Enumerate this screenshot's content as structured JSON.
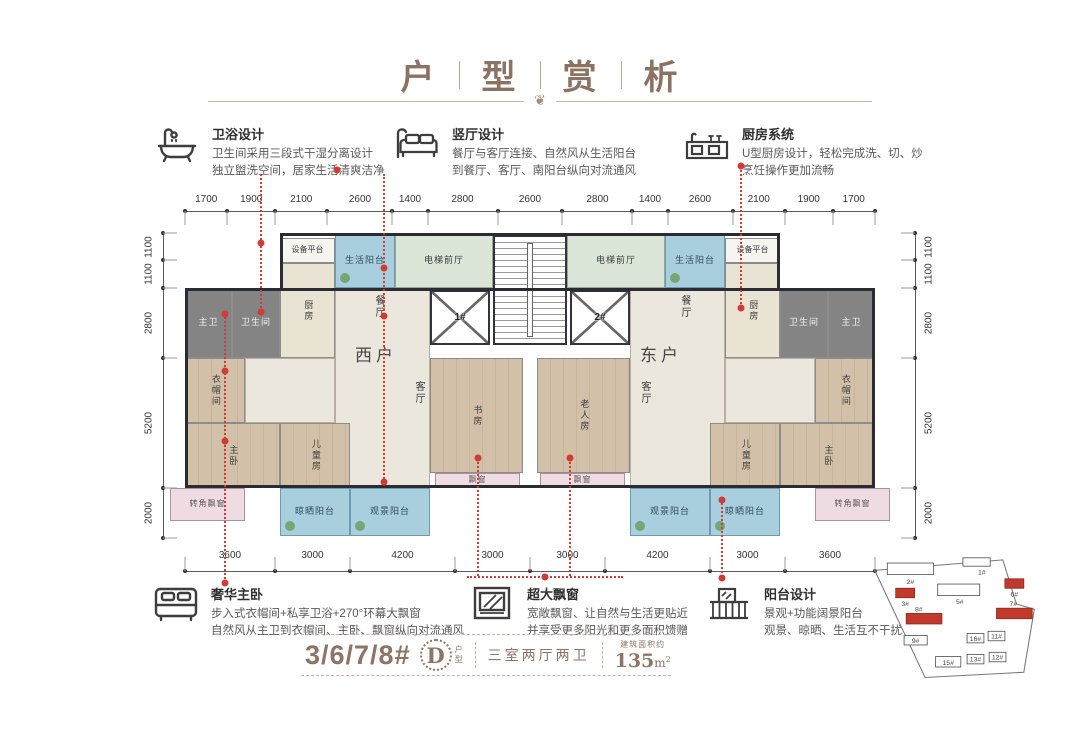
{
  "title": {
    "chars": [
      "户",
      "型",
      "赏",
      "析"
    ],
    "ornament": "❦"
  },
  "features_top": [
    {
      "icon": "bathtub-icon",
      "title": "卫浴设计",
      "lines": [
        "卫生间采用三段式干湿分离设计",
        "独立盥洗空间，居家生活清爽洁净"
      ]
    },
    {
      "icon": "sofa-lamp-icon",
      "title": "竖厅设计",
      "lines": [
        "餐厅与客厅连接、自然风从生活阳台",
        "到餐厅、客厅、南阳台纵向对流通风"
      ]
    },
    {
      "icon": "kitchen-icon",
      "title": "厨房系统",
      "lines": [
        "U型厨房设计，轻松完成洗、切、炒",
        "烹饪操作更加流畅"
      ]
    }
  ],
  "features_bottom": [
    {
      "icon": "bed-icon",
      "title": "奢华主卧",
      "lines": [
        "步入式衣帽间+私享卫浴+270°环幕大飘窗",
        "自然风从主卫到衣帽间、主卧、飘窗纵向对流通风"
      ]
    },
    {
      "icon": "window-icon",
      "title": "超大飘窗",
      "lines": [
        "宽敞飘窗、让自然与生活更贴近",
        "并享受更多阳光和更多面积馈赠"
      ]
    },
    {
      "icon": "balcony-icon",
      "title": "阳台设计",
      "lines": [
        "景观+功能阔景阳台",
        "观景、晾晒、生活互不干扰"
      ]
    }
  ],
  "dimensions": {
    "top": [
      1700,
      1900,
      2100,
      2600,
      1400,
      2800,
      2600,
      2800,
      1400,
      2600,
      2100,
      1900,
      1700
    ],
    "bottom": [
      3600,
      3000,
      4200,
      3000,
      3000,
      4200,
      3000,
      3600
    ],
    "side": [
      1100,
      1100,
      2800,
      5200,
      2000
    ]
  },
  "plan": {
    "rooms": [
      {
        "id": "living-dining-west",
        "label": "",
        "x": 150,
        "y": 55,
        "w": 95,
        "h": 200,
        "cls": "tile"
      },
      {
        "id": "corridor-west",
        "label": "",
        "x": 60,
        "y": 125,
        "w": 90,
        "h": 65,
        "cls": "tile"
      },
      {
        "id": "living-dining-east",
        "label": "",
        "x": 445,
        "y": 55,
        "w": 95,
        "h": 200,
        "cls": "tile"
      },
      {
        "id": "corridor-east",
        "label": "",
        "x": 540,
        "y": 125,
        "w": 90,
        "h": 65,
        "cls": "tile"
      },
      {
        "id": "equipment-platform-west",
        "label": "设备平台",
        "x": 95,
        "y": 5,
        "w": 55,
        "h": 25,
        "cls": "equip"
      },
      {
        "id": "life-balcony-west",
        "label": "生活阳台",
        "x": 150,
        "y": 0,
        "w": 60,
        "h": 55,
        "cls": "balcony"
      },
      {
        "id": "elevator-lobby-west",
        "label": "电梯前厅",
        "x": 210,
        "y": 0,
        "w": 98,
        "h": 55,
        "cls": "lobby"
      },
      {
        "id": "master-bath-west",
        "label": "主卫",
        "x": 0,
        "y": 55,
        "w": 47,
        "h": 70,
        "cls": "bath"
      },
      {
        "id": "bathroom-west",
        "label": "卫生间",
        "x": 47,
        "y": 55,
        "w": 48,
        "h": 70,
        "cls": "bath"
      },
      {
        "id": "kitchen-west",
        "label": "厨房",
        "x": 95,
        "y": 30,
        "w": 55,
        "h": 95,
        "cls": "kitchen",
        "vert": true
      },
      {
        "id": "closet-west",
        "label": "衣帽间",
        "x": 0,
        "y": 125,
        "w": 60,
        "h": 65,
        "cls": "wood",
        "vert": true
      },
      {
        "id": "master-bedroom-west",
        "label": "主卧",
        "x": 0,
        "y": 190,
        "w": 95,
        "h": 65,
        "cls": "wood",
        "vert": true
      },
      {
        "id": "kids-room-west",
        "label": "儿童房",
        "x": 95,
        "y": 190,
        "w": 70,
        "h": 65,
        "cls": "wood",
        "vert": true
      },
      {
        "id": "study-west",
        "label": "书房",
        "x": 245,
        "y": 125,
        "w": 93,
        "h": 115,
        "cls": "wood",
        "vert": true
      },
      {
        "id": "bay-window-west",
        "label": "飘窗",
        "x": 250,
        "y": 240,
        "w": 85,
        "h": 15,
        "cls": "bay"
      },
      {
        "id": "corner-bay-west",
        "label": "转角飘窗",
        "x": -15,
        "y": 255,
        "w": 75,
        "h": 33,
        "cls": "bay"
      },
      {
        "id": "drying-balcony-west",
        "label": "晾晒阳台",
        "x": 95,
        "y": 255,
        "w": 70,
        "h": 48,
        "cls": "balcony"
      },
      {
        "id": "view-balcony-west",
        "label": "观景阳台",
        "x": 165,
        "y": 255,
        "w": 80,
        "h": 48,
        "cls": "balcony"
      },
      {
        "id": "equipment-platform-east",
        "label": "设备平台",
        "x": 540,
        "y": 5,
        "w": 55,
        "h": 25,
        "cls": "equip"
      },
      {
        "id": "life-balcony-east",
        "label": "生活阳台",
        "x": 480,
        "y": 0,
        "w": 60,
        "h": 55,
        "cls": "balcony"
      },
      {
        "id": "elevator-lobby-east",
        "label": "电梯前厅",
        "x": 382,
        "y": 0,
        "w": 98,
        "h": 55,
        "cls": "lobby"
      },
      {
        "id": "bathroom-east",
        "label": "卫生间",
        "x": 595,
        "y": 55,
        "w": 48,
        "h": 70,
        "cls": "bath"
      },
      {
        "id": "master-bath-east",
        "label": "主卫",
        "x": 643,
        "y": 55,
        "w": 47,
        "h": 70,
        "cls": "bath"
      },
      {
        "id": "kitchen-east",
        "label": "厨房",
        "x": 540,
        "y": 30,
        "w": 55,
        "h": 95,
        "cls": "kitchen",
        "vert": true
      },
      {
        "id": "closet-east",
        "label": "衣帽间",
        "x": 630,
        "y": 125,
        "w": 60,
        "h": 65,
        "cls": "wood",
        "vert": true
      },
      {
        "id": "master-bedroom-east",
        "label": "主卧",
        "x": 595,
        "y": 190,
        "w": 95,
        "h": 65,
        "cls": "wood",
        "vert": true
      },
      {
        "id": "kids-room-east",
        "label": "儿童房",
        "x": 525,
        "y": 190,
        "w": 70,
        "h": 65,
        "cls": "wood",
        "vert": true
      },
      {
        "id": "elder-room-east",
        "label": "老人房",
        "x": 352,
        "y": 125,
        "w": 93,
        "h": 115,
        "cls": "wood",
        "vert": true
      },
      {
        "id": "bay-window-east",
        "label": "飘窗",
        "x": 355,
        "y": 240,
        "w": 85,
        "h": 15,
        "cls": "bay"
      },
      {
        "id": "corner-bay-east",
        "label": "转角飘窗",
        "x": 630,
        "y": 255,
        "w": 75,
        "h": 33,
        "cls": "bay"
      },
      {
        "id": "view-balcony-east",
        "label": "观景阳台",
        "x": 445,
        "y": 255,
        "w": 80,
        "h": 48,
        "cls": "balcony"
      },
      {
        "id": "drying-balcony-east",
        "label": "晾晒阳台",
        "x": 525,
        "y": 255,
        "w": 70,
        "h": 48,
        "cls": "balcony"
      }
    ],
    "labels": [
      {
        "text": "西户",
        "x": 170,
        "y": 108,
        "cls": "unit"
      },
      {
        "text": "东户",
        "x": 455,
        "y": 108,
        "cls": "unit"
      },
      {
        "text": "餐厅",
        "x": 186,
        "y": 62,
        "cls": "vert"
      },
      {
        "text": "餐厅",
        "x": 492,
        "y": 62,
        "cls": "vert"
      },
      {
        "text": "客厅",
        "x": 226,
        "y": 148,
        "cls": "vert"
      },
      {
        "text": "客厅",
        "x": 452,
        "y": 148,
        "cls": "vert"
      }
    ],
    "elevators": [
      {
        "label": "1#",
        "x": 245,
        "y": 57,
        "w": 60,
        "h": 55
      },
      {
        "label": "2#",
        "x": 385,
        "y": 57,
        "w": 60,
        "h": 55
      }
    ]
  },
  "summary": {
    "building_numbers": "3/6/7/8#",
    "type_letter": "D",
    "type_suffix_chars": [
      "户",
      "型"
    ],
    "layout": "三室两厅两卫",
    "area_prefix": "建筑面积约",
    "area_value": "135",
    "area_unit": "m",
    "area_sup": "2"
  },
  "sitemap": {
    "buildings": [
      {
        "label": "2#",
        "x": 26,
        "y": 6,
        "w": 44,
        "h": 11,
        "red": false,
        "lx": 48,
        "ly": 26
      },
      {
        "label": "1#",
        "x": 98,
        "y": 1,
        "w": 26,
        "h": 8,
        "red": false,
        "lx": 116,
        "ly": 17
      },
      {
        "label": "5#",
        "x": 74,
        "y": 26,
        "w": 40,
        "h": 11,
        "red": false,
        "lx": 95,
        "ly": 45
      },
      {
        "label": "3#",
        "x": 34,
        "y": 30,
        "w": 18,
        "h": 9,
        "red": true,
        "lx": 43,
        "ly": 47
      },
      {
        "label": "6#",
        "x": 138,
        "y": 21,
        "w": 18,
        "h": 9,
        "red": true,
        "lx": 147,
        "ly": 38
      },
      {
        "label": "8#",
        "x": 44,
        "y": 54,
        "w": 34,
        "h": 10,
        "red": true,
        "lx": 56,
        "ly": 52
      },
      {
        "label": "7#",
        "x": 130,
        "y": 49,
        "w": 34,
        "h": 10,
        "red": true,
        "lx": 146,
        "ly": 47
      },
      {
        "label": "9#",
        "x": 42,
        "y": 75,
        "w": 22,
        "h": 9,
        "red": false,
        "lx": 53,
        "ly": 82
      },
      {
        "label": "15#",
        "x": 72,
        "y": 95,
        "w": 24,
        "h": 10,
        "red": false,
        "lx": 84,
        "ly": 103
      },
      {
        "label": "16#",
        "x": 102,
        "y": 73,
        "w": 16,
        "h": 9,
        "red": false,
        "lx": 110,
        "ly": 80
      },
      {
        "label": "11#",
        "x": 122,
        "y": 71,
        "w": 16,
        "h": 9,
        "red": false,
        "lx": 130,
        "ly": 78
      },
      {
        "label": "13#",
        "x": 102,
        "y": 93,
        "w": 16,
        "h": 9,
        "red": false,
        "lx": 110,
        "ly": 100
      },
      {
        "label": "12#",
        "x": 123,
        "y": 91,
        "w": 16,
        "h": 9,
        "red": false,
        "lx": 131,
        "ly": 98
      }
    ]
  }
}
